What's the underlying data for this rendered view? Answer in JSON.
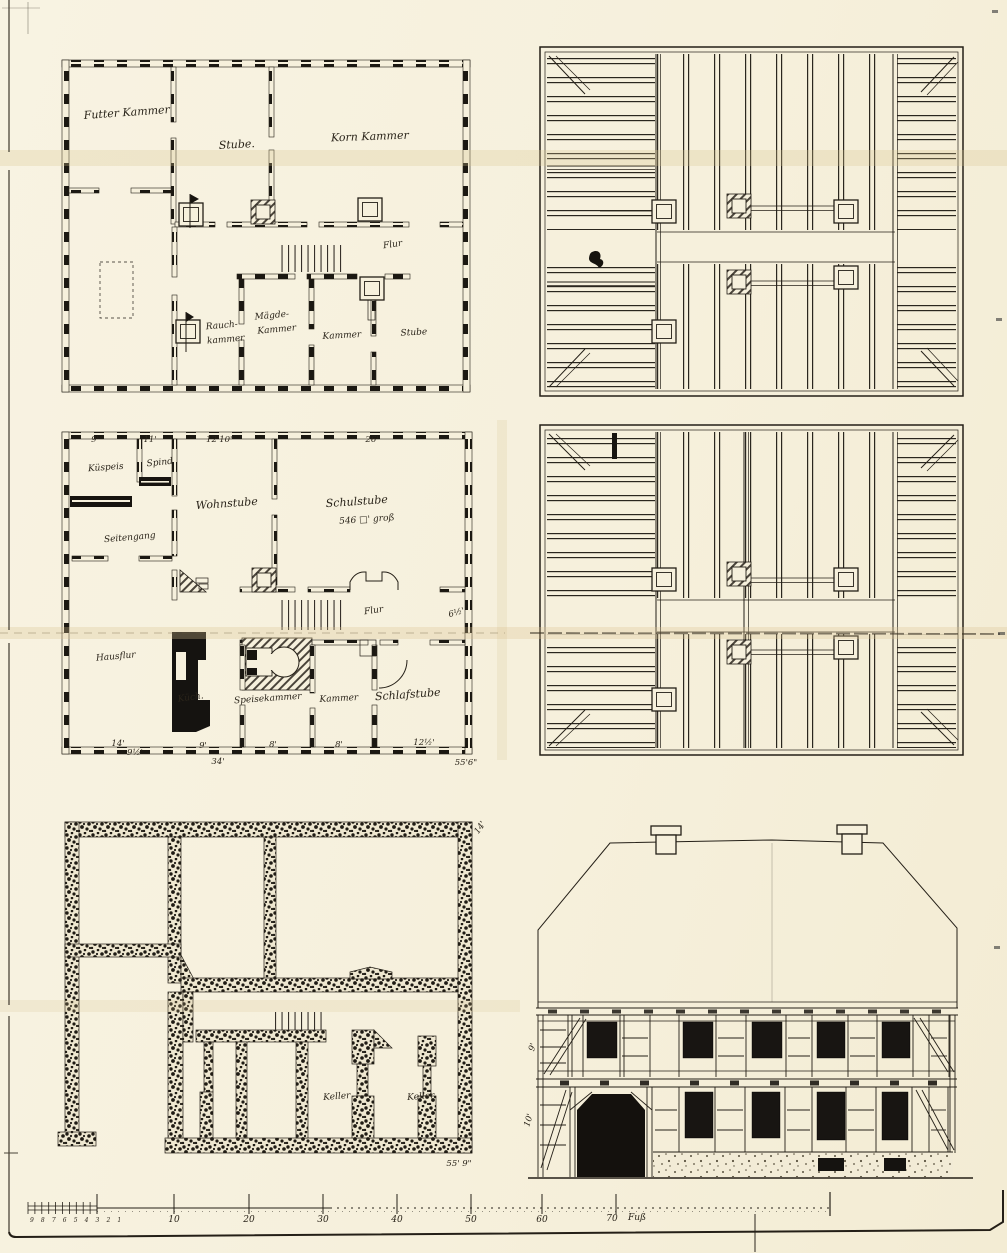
{
  "upper_plan": {
    "room_top_left": "Futter Kammer",
    "room_top_mid": "Stube.",
    "room_top_right": "Korn Kammer",
    "hall": "Flur",
    "smoke_1": "Rauch-",
    "smoke_2": "kammer",
    "maid_1": "Mägde-",
    "maid_2": "Kammer",
    "chamber": "Kammer",
    "parlor": "Stube"
  },
  "ground_plan": {
    "dims_top": [
      "9'",
      "11'",
      "12'10\"",
      "26'"
    ],
    "pantry": "Küspeis",
    "closet": "Spind",
    "side_passage": "Seitengang",
    "living_room": "Wohnstube",
    "school_room": "Schulstube",
    "school_room_size": "546 □' groß",
    "hall": "Flur",
    "dim_right": "6½'",
    "house_hall": "Hausflur",
    "kitchen": "Küch.",
    "pantry2": "Speisekammer",
    "chamber": "Kammer",
    "bedroom": "Schlafstube",
    "dims_bottom": [
      "14'",
      "9½'",
      "9'",
      "8'",
      "8'",
      "12½'",
      "34'",
      "55'6\""
    ]
  },
  "basement_plan": {
    "cellar_left": "Keller",
    "cellar_right": "Keller",
    "dim_total": "55' 9\"",
    "dim_corner": "14'"
  },
  "elevation": {
    "dim_upper": "9'",
    "dim_lower": "10'"
  },
  "scale_bar": {
    "minor": "9 8 7 6 5 4 3 2 1",
    "majors": [
      "10",
      "20",
      "30",
      "40",
      "50",
      "60",
      "70"
    ],
    "unit": "Fuß"
  }
}
